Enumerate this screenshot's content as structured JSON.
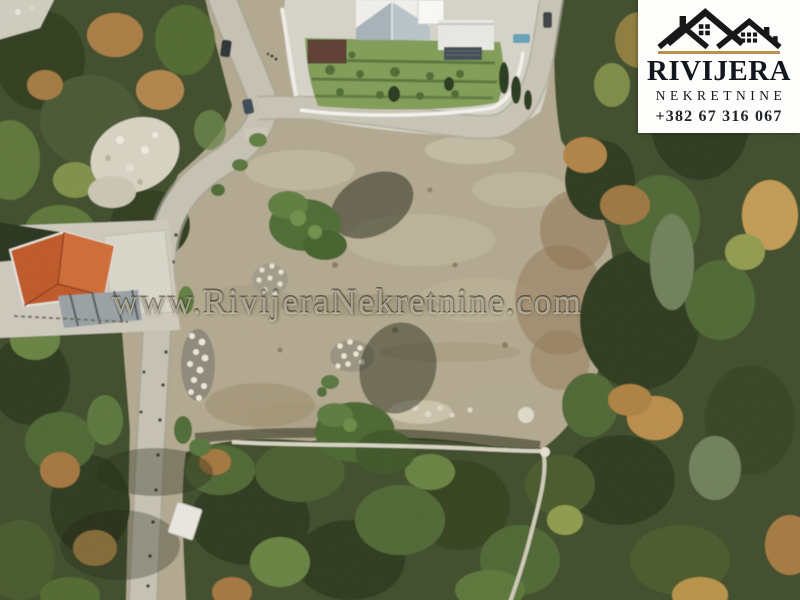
{
  "photo": {
    "kind": "aerial-drone-photo-of-building-land-plot",
    "watermark_text": "www.RivijeraNekretnine.com"
  },
  "logo": {
    "brand_name": "RIVIJERA",
    "brand_subtitle": "NEKRETNINE",
    "phone_number": "+382 67 316 067",
    "icon": "twin-house-roofs-icon",
    "colors": {
      "plate_background": "#fdfdfc",
      "roofs_black": "#181818",
      "accent_gold": "#b7944a",
      "text_dark": "#12171d"
    }
  },
  "scene_colors": {
    "dirt_plot": "#b2a88f",
    "dirt_warm": "#a08a6a",
    "road_asphalt": "#c6c2b3",
    "forest_dark_green": "#3d4c2c",
    "forest_mid_green": "#55703a",
    "autumn_orange": "#b08244",
    "lawn_green": "#7f9c55",
    "terracotta_roof": "#bf5627",
    "villa_white": "#f1f0ec",
    "stone_rubble": "#e8e4d6"
  }
}
